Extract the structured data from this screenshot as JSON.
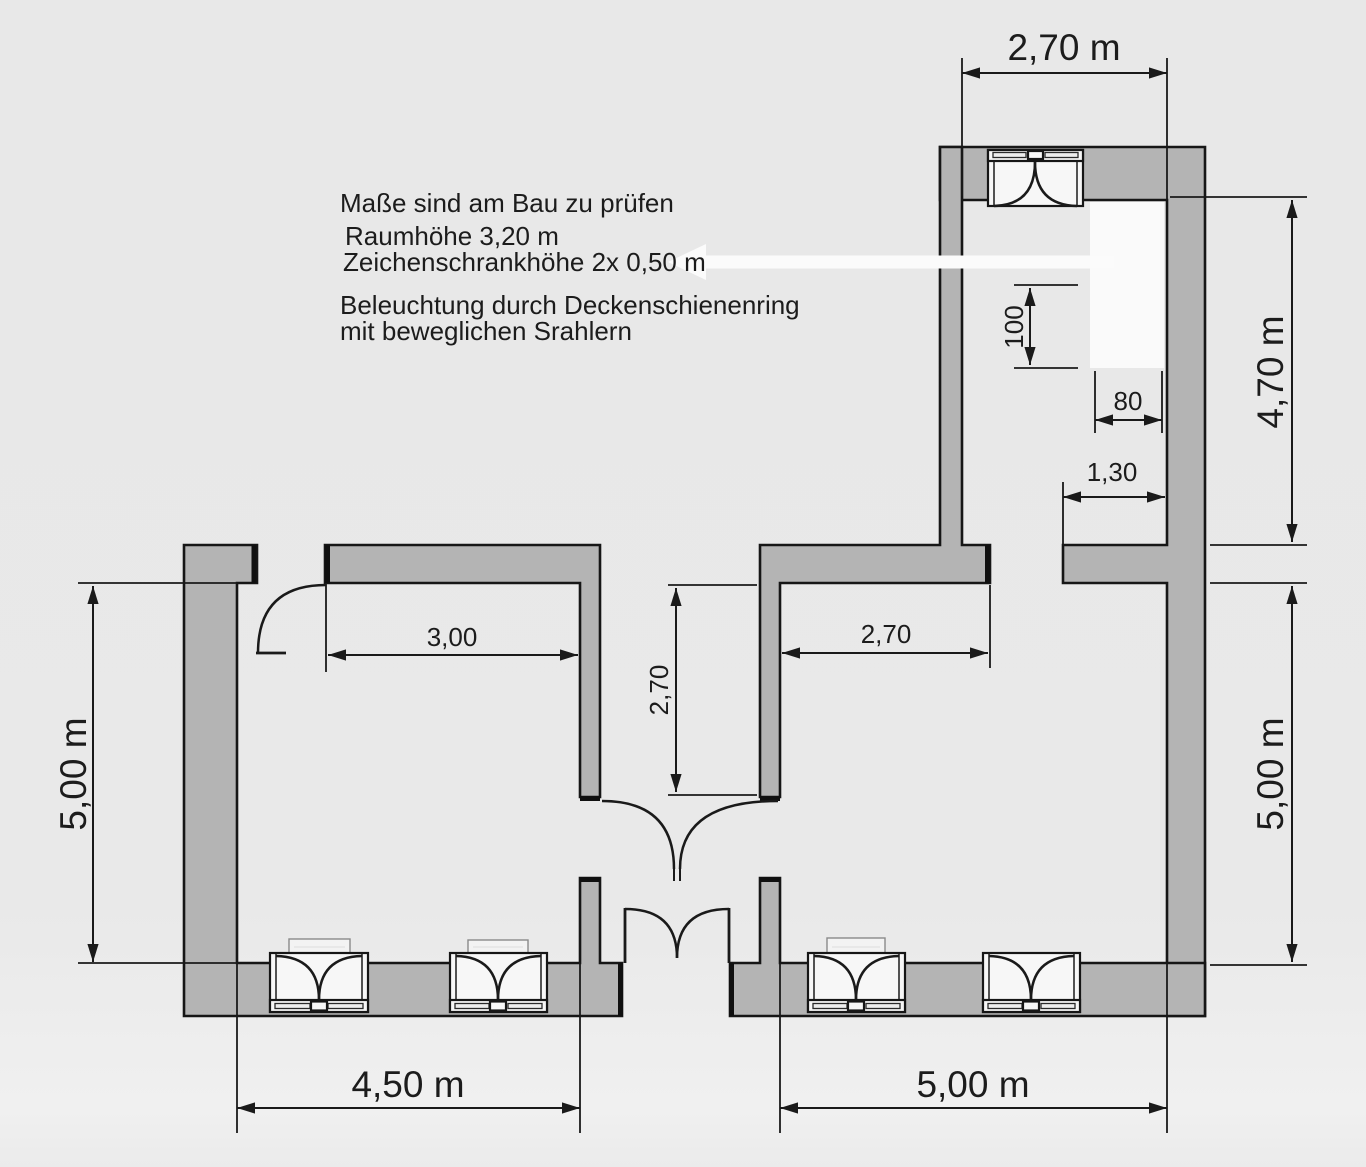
{
  "annotations": {
    "note_measure": "Maße sind am Bau zu prüfen",
    "note_room_height": "Raumhöhe 3,20 m",
    "note_cabinet_height": "Zeichenschrankhöhe 2x 0,50 m",
    "note_lighting_line1": "Beleuchtung durch Deckenschienenring",
    "note_lighting_line2": "mit beweglichen Srahlern"
  },
  "dimensions": {
    "top_room_width": "2,70 m",
    "upper_right_height": "4,70 m",
    "lower_right_height": "5,00 m",
    "left_height": "5,00 m",
    "bottom_left_width": "4,50 m",
    "bottom_right_width": "5,00 m",
    "door_wall_offset": "3,00",
    "right_room_opening": "2,70",
    "corridor_depth": "2,70",
    "wall_segment_length": "1,30",
    "cabinet_depth": "100",
    "cabinet_width": "80"
  },
  "colors": {
    "background": "#e9e9e9",
    "wall_fill": "#b4b4b4",
    "line": "#1a1a1a",
    "highlight_white": "#f9f9f9"
  }
}
